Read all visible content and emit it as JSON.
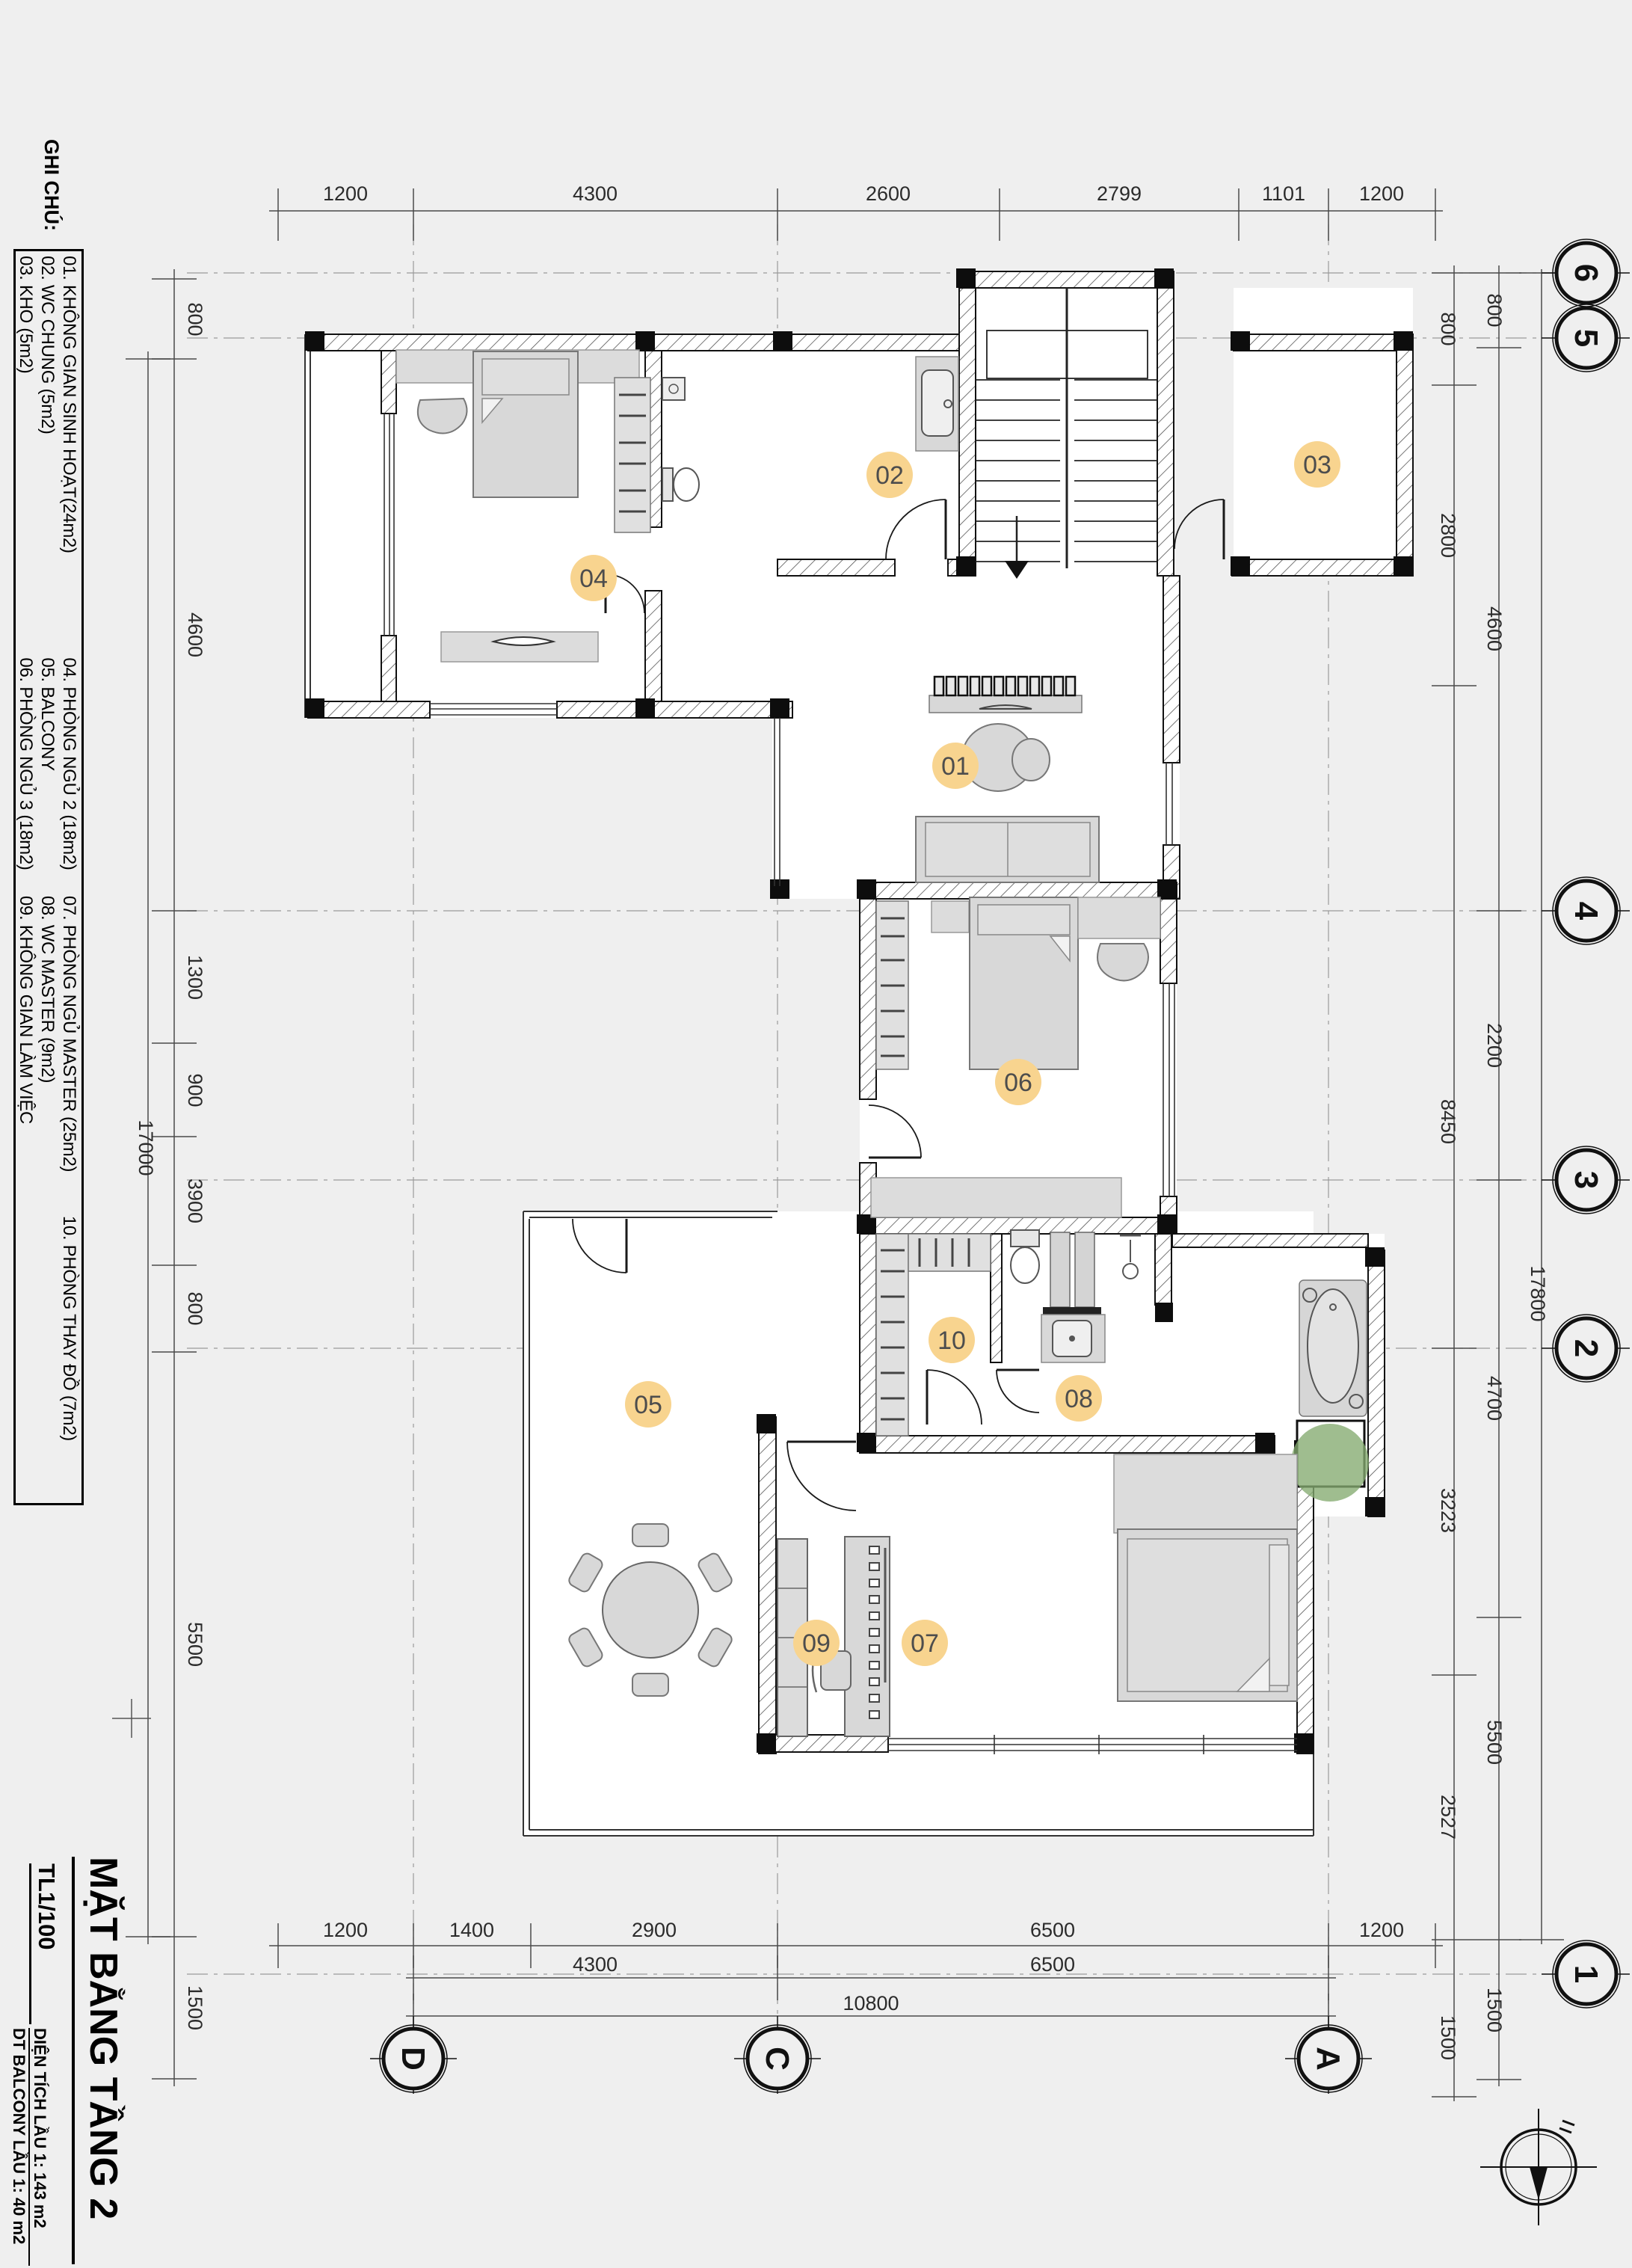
{
  "sheet": {
    "background": "#efefef",
    "line_color": "#1a1a1a"
  },
  "legend": {
    "heading": "GHI CHÚ:",
    "rows": [
      [
        "01. KHÔNG GIAN SINH HOẠT(24m2)",
        "04. PHÒNG NGỦ 2 (18m2)",
        "07. PHÒNG NGỦ MASTER (25m2)",
        "10. PHÒNG THAY ĐỒ (7m2)"
      ],
      [
        "02. WC CHUNG (5m2)",
        "05. BALCONY",
        "08. WC MASTER (9m2)",
        ""
      ],
      [
        "03. KHO (5m2)",
        "06. PHÒNG NGỦ 3 (18m2)",
        "09. KHÔNG GIAN LÀM VIỆC",
        ""
      ]
    ]
  },
  "title_block": {
    "title": "MẶT BẰNG TẦNG 2",
    "scale": "TL1/100",
    "area_floor": "DIỆN TÍCH LẦU 1: 143 m2",
    "area_balcony": "DT BALCONY LẦU 1: 40 m2"
  },
  "grid": {
    "bottom": [
      "D",
      "C",
      "A"
    ],
    "right": [
      "6",
      "5",
      "4",
      "3",
      "2",
      "1"
    ]
  },
  "dims": {
    "top": [
      "1200",
      "4300",
      "2600",
      "2799",
      "1101",
      "1200"
    ],
    "bottom1": [
      "1200",
      "1400",
      "2900",
      "6500",
      "1200"
    ],
    "bottom2": [
      "4300",
      "6500"
    ],
    "bottom3": [
      "10800"
    ],
    "left": [
      "800",
      "4600",
      "1300",
      "900",
      "3900",
      "800",
      "5500",
      "1500"
    ],
    "left_overall": "17000",
    "right_inner": [
      "800",
      "2800",
      "8450",
      "3223",
      "2527",
      "1500"
    ],
    "right_mid": [
      "800",
      "4600",
      "2200",
      "4700",
      "5500",
      "1500"
    ],
    "right_overall": "17800"
  },
  "rooms": [
    {
      "number": "01"
    },
    {
      "number": "02"
    },
    {
      "number": "03"
    },
    {
      "number": "04"
    },
    {
      "number": "05"
    },
    {
      "number": "06"
    },
    {
      "number": "07"
    },
    {
      "number": "08"
    },
    {
      "number": "09"
    },
    {
      "number": "10"
    }
  ],
  "colors": {
    "room_badge": "#f8d48f",
    "furniture": "#d8d8d8",
    "plant": "#84ab70",
    "wall": "#111111"
  }
}
